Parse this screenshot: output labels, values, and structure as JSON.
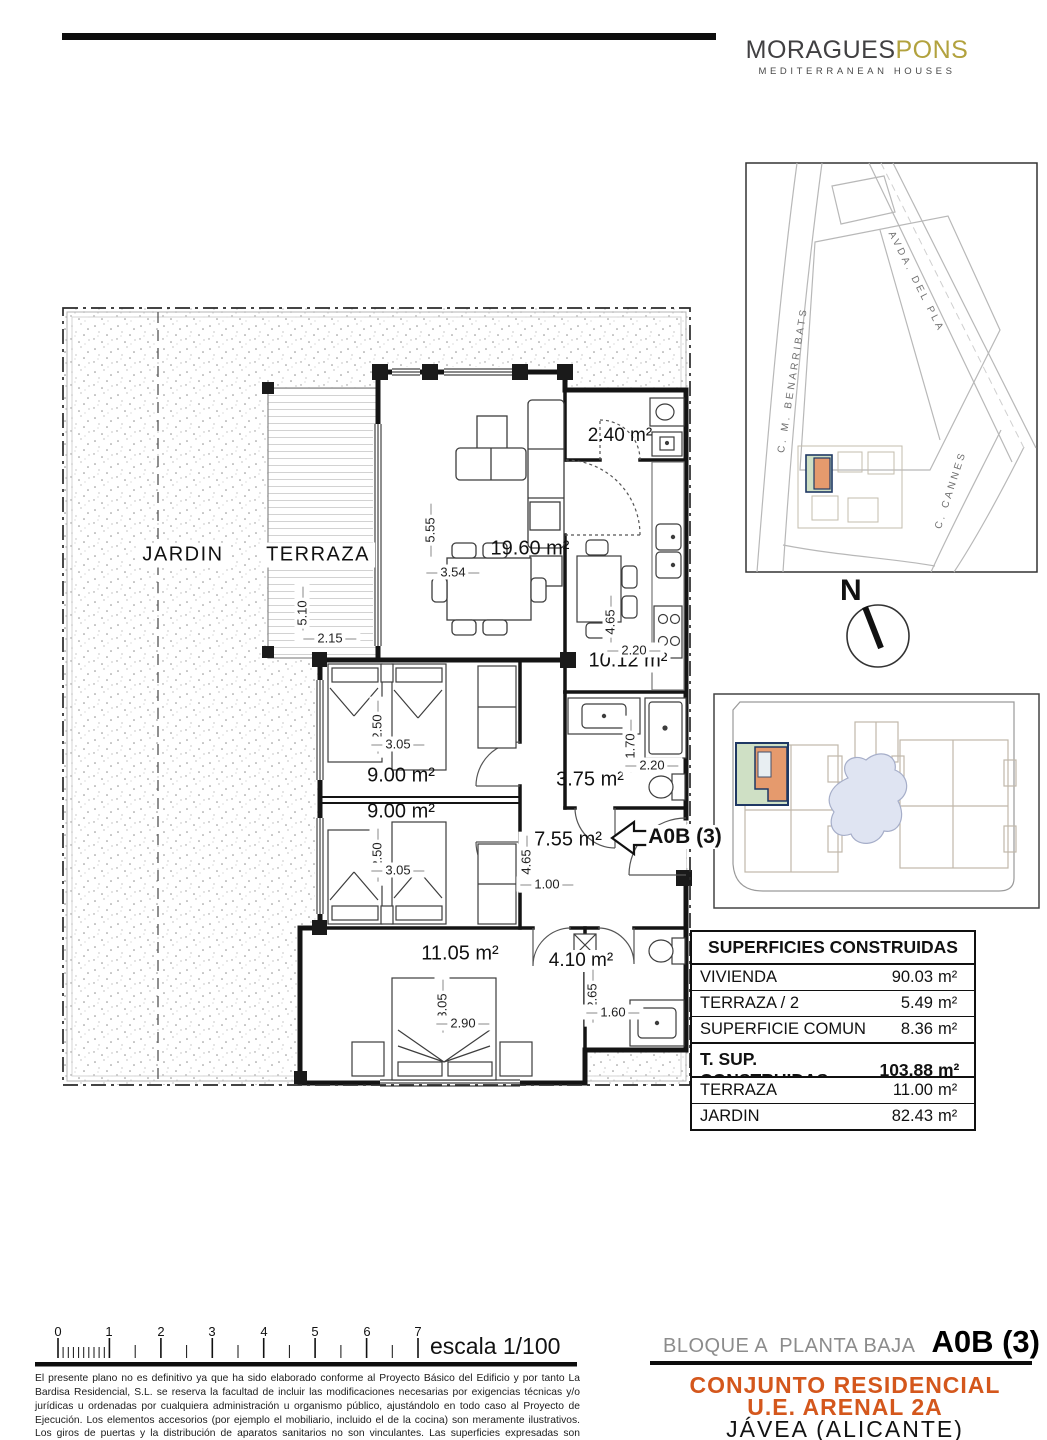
{
  "logo": {
    "brand_primary": "MORAGUES",
    "brand_secondary": "PONS",
    "tagline": "MEDITERRANEAN HOUSES"
  },
  "location_map": {
    "street_top": "AVDA. DEL PLA",
    "street_left": "C. M. BENARRIBATS",
    "street_right": "C. CANNES"
  },
  "compass": {
    "north_label": "N"
  },
  "plan": {
    "jardin_label": "JARDIN",
    "terraza_label": "TERRAZA",
    "living_area": "19.60 m²",
    "laundry_area": "2.40 m²",
    "kitchen_area": "10.12 m²",
    "bedroom1_area": "9.00 m²",
    "bedroom2_area": "9.00 m²",
    "bath1_area": "3.75 m²",
    "hall_area": "7.55 m²",
    "master_area": "11.05 m²",
    "bath2_area": "4.10 m²",
    "unit_tag": "A0B (3)",
    "dims": {
      "living_h": "5.55",
      "living_w": "3.54",
      "terraza_h": "5.10",
      "terraza_w": "2.15",
      "kitchen_h": "4.65",
      "kitchen_w": "2.20",
      "bed1_h": "2.50",
      "bed1_w": "3.05",
      "bed2_h": "2.50",
      "bed2_w": "3.05",
      "bath1_h": "1.70",
      "bath1_w": "2.20",
      "hall_h": "4.65",
      "hall_w": "1.00",
      "master_h": "3.05",
      "master_w": "2.90",
      "bath2_h": "2.65",
      "bath2_w": "1.60"
    }
  },
  "surfaces": {
    "title": "SUPERFICIES CONSTRUIDAS",
    "rows": [
      {
        "label": "VIVIENDA",
        "value": "90.03",
        "unit": "m²"
      },
      {
        "label": "TERRAZA / 2",
        "value": "5.49",
        "unit": "m²"
      },
      {
        "label": "SUPERFICIE COMUN",
        "value": "8.36",
        "unit": "m²"
      }
    ],
    "total": {
      "label": "T. SUP. CONSTRUIDAS",
      "value": "103.88",
      "unit": "m²"
    },
    "outdoor": [
      {
        "label": "TERRAZA",
        "value": "11.00",
        "unit": "m²"
      },
      {
        "label": "JARDIN",
        "value": "82.43",
        "unit": "m²"
      }
    ]
  },
  "footer": {
    "scale_numbers": [
      "0",
      "1",
      "2",
      "3",
      "4",
      "5",
      "6",
      "7"
    ],
    "scale_label": "escala 1/100",
    "block_label": "BLOQUE A  PLANTA BAJA",
    "unit_label": "A0B (3)",
    "project_line1": "CONJUNTO RESIDENCIAL",
    "project_line2": "U.E. ARENAL 2A",
    "city_line": "JÁVEA (ALICANTE)",
    "disclaimer": "El presente plano no es definitivo ya que ha sido elaborado conforme al Proyecto Básico del Edificio y por tanto La Bardisa Residencial, S.L. se reserva la facultad de incluir las modificaciones necesarias por exigencias técnicas y/o jurídicas u ordenadas por cualquiera  administración u organismo público, ajustándolo en todo caso al Proyecto de Ejecución. Los elementos accesorios (por ejemplo el mobiliario, incluido el de la cocina) son meramente ilustrativos. Los giros de puertas y la distribución de aparatos sanitarios no son vinculantes. Las superficies expresadas son aproximadas pudiendo experimentar modificaciones por razones de índole técnicas y/o legales en el desarrollo de la ejecución de las obras."
  },
  "colors": {
    "accent_orange": "#d4571c",
    "logo_olive": "#b2a23e",
    "highlight_orange": "#e59a6d",
    "highlight_green": "#cfe0c5",
    "highlight_navy": "#1f3864",
    "pool_blue": "#dfe4f2"
  }
}
